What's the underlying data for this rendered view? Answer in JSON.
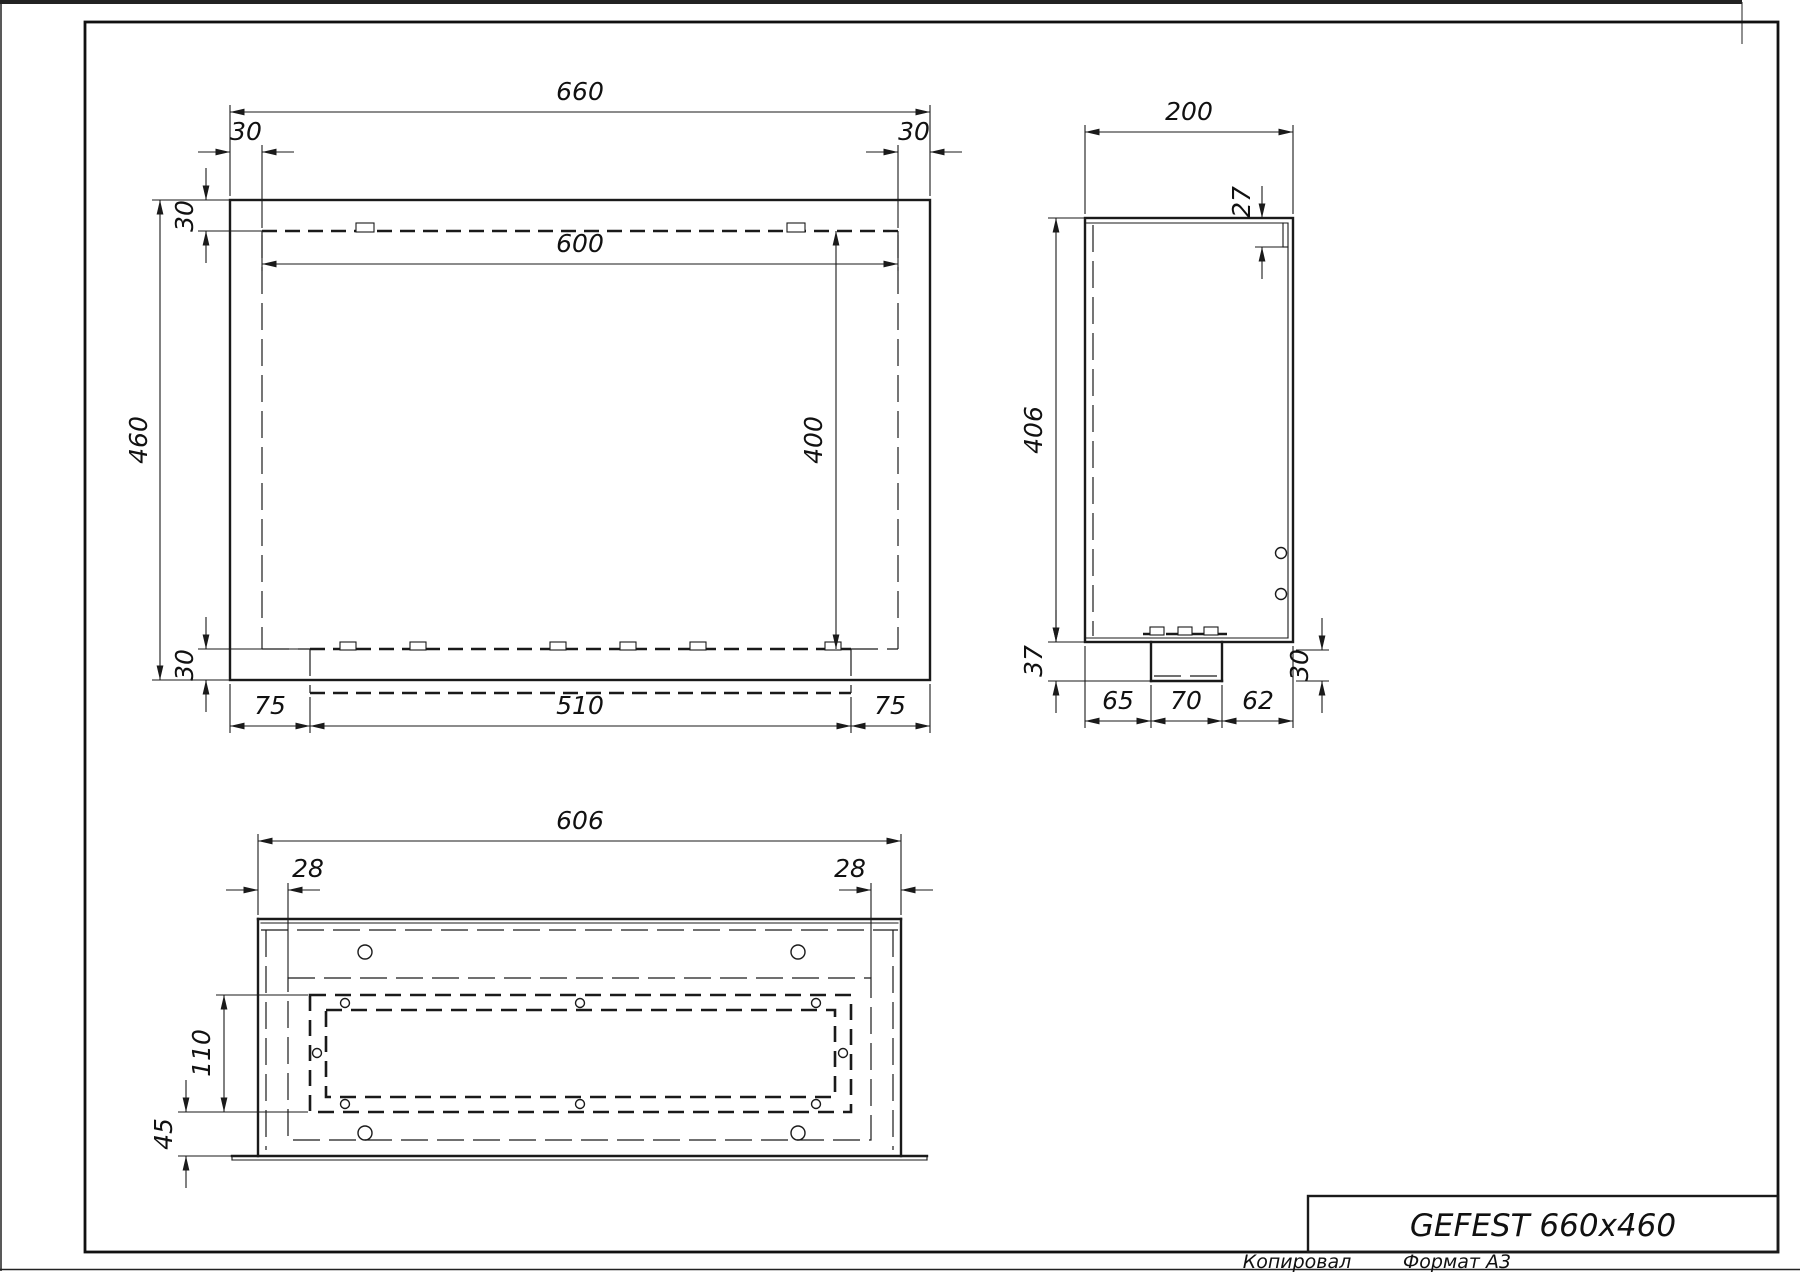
{
  "title_block": {
    "title": "GEFEST 660x460",
    "copied_label": "Копировал",
    "format_label": "Формат А3"
  },
  "front_view": {
    "total_width": "660",
    "left_inset": "30",
    "right_inset": "30",
    "top_band": "30",
    "total_height": "460",
    "opening_width": "600",
    "opening_height": "400",
    "bottom_band": "30",
    "tray_left_margin": "75",
    "tray_width": "510",
    "tray_right_margin": "75"
  },
  "side_view": {
    "depth": "200",
    "lip_height": "27",
    "panel_height": "406",
    "tray_depth": "37",
    "bottom_seg_left": "65",
    "bottom_seg_mid": "70",
    "bottom_seg_right": "62",
    "tray_bottom_offset": "30"
  },
  "bottom_view": {
    "total_width": "606",
    "left_inset": "28",
    "right_inset": "28",
    "opening_height": "110",
    "flange_offset": "45"
  }
}
